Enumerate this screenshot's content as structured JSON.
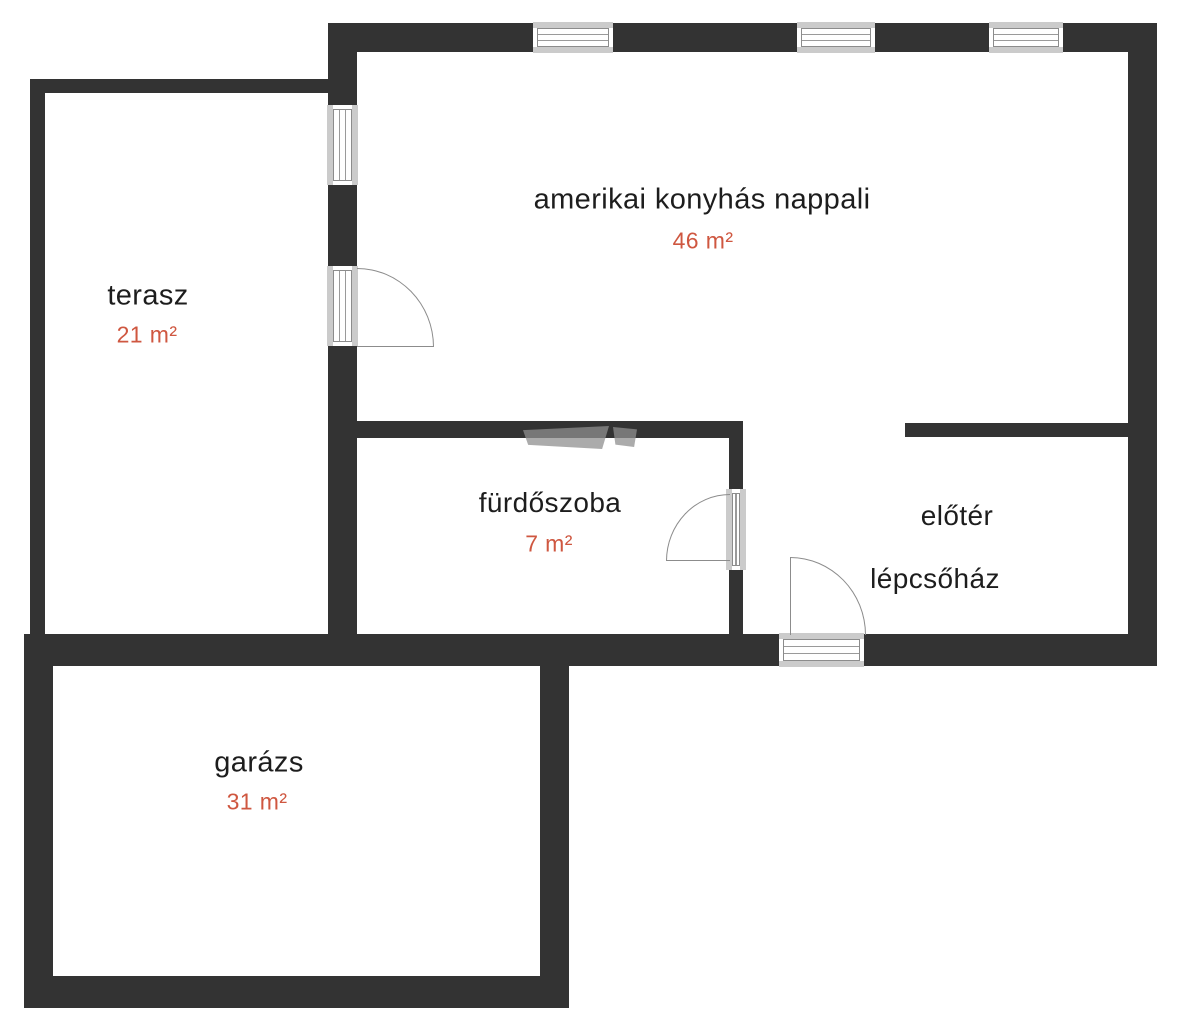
{
  "plan_title": "floor-plan",
  "rooms": {
    "living": {
      "name": "amerikai konyhás nappali",
      "area": "46 m²"
    },
    "terrace": {
      "name": "terasz",
      "area": "21 m²"
    },
    "bathroom": {
      "name": "fürdőszoba",
      "area": "7 m²"
    },
    "foyer": {
      "name": "előtér",
      "area": ""
    },
    "staircase": {
      "name": "lépcsőház",
      "area": ""
    },
    "garage": {
      "name": "garázs",
      "area": "31 m²"
    }
  },
  "colors": {
    "wall": "#333333",
    "room_text": "#1d1d1d",
    "area_text": "#cf5740",
    "window_sill": "#cbcbcb",
    "window_line": "#8c8c8c",
    "door_arc": "#8c8c8c",
    "background": "#ffffff"
  },
  "icons": {
    "window": "window-icon",
    "door_swing": "door-swing-icon"
  }
}
